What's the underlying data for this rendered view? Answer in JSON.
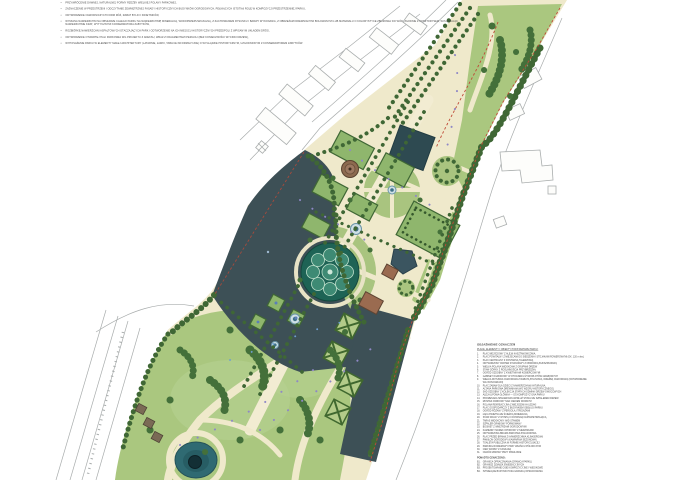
{
  "annotations": {
    "bullets": [
      "PRZYWRÓCENIE DAWNEJ, NATURALNEJ FORMY RZEŹBY WIELKIEJ POLANY PARKOWEJ,",
      "ZAZNACZENIE W PRZESTRZENI I ODCZYTANIE ZEWNĘTRZNEJ FASADY HISTORYCZNYCH BUDYNKÓW OGRODOWYCH, PEŁNIĄCYCH ISTOTNĄ ROLĘ W KOMPOZYCJI PRZESTRZENNEJ PARKU,",
      "ODTWORZENIE OGRODNICZYCH FORM RÓŻ, RABAT BYLIN I KWIETNIKÓW,",
      "WYMIANA NAWIERZCHNI NA OBSZARZE CAŁEGO PARKU NA NAWIERZCHNIĘ MINERALNĄ, WODOPRZEPUSZCZALNĄ, Z ZACHOWANIEM RYSUNKU I BARWY WYKONANIA, Z OBRZEŻAMI DREWNIANYMI BOLOWANYMI LUB MATERIAŁU O KOLORYSTYCE ZBLIŻONEJ DO WÓD, ZGODNIE Z KOSZTORYSEM, WYŁĄCZAJĄC NAWIERZCHNIE KRAT, WYTYCZNYMI KONSERWATORA ZABYTKÓW,",
      "ROZBIÓRKĘ NAWIERZCHNI ASFALTOWYCH OTACZAJĄCYCH PARK I ODTWORZENIE NA ICH MIEJSCU HISTORYCZNYCH PRZEDPOLI Z WPISANYM UKŁADEM DRÓG,",
      "ODTWORZENIE OTWARTEJ HALI PARKOWEJ WG PROJEKTU Z ANEKSU, WRAZ Z FRAGMENTAMI PERGOLI (BEZ KONIECZNOŚCI WYCINKI DRZEW),",
      "WYPOSAŻENIE PARKU W ELEMENTY MAŁEJ ARCHITEKTURY (LATARNIE, ŁAWKI, TABLICE INFORMACYJNE) O WYGLĄDZIE HISTORYCZNYM, UZGODNIONYM Z KONSERWATOREM ZABYTKÓW."
    ]
  },
  "legend": {
    "title": "OBJAŚNIENIE OZNACZEŃ",
    "subtitle": "PLACE, ELEMENTY I OBIEKTY PODSTAWOWE PARKU:",
    "items": [
      {
        "num": "1.",
        "text": "PLAC WEJŚCIOWY Z ALEJĄ KASZTANOWCOWĄ"
      },
      {
        "num": "2.",
        "text": "PLAC POWITALNY Z MIEJSCAMI DO SIEDZENIA I STOJAKAMI ROWEROWYMI (OK. 120 m kw.)"
      },
      {
        "num": "3.",
        "text": "PLAC CENTRALNY Z FONTANNĄ TALERZOWĄ"
      },
      {
        "num": "4.",
        "text": "ODTWORZONY PARTER DYWANOWY Z OBWÓDKĄ BUKSZPANOWĄ"
      },
      {
        "num": "5.",
        "text": "WIELKA POLANA WIDOKOWA Z GRUPAMI DRZEW"
      },
      {
        "num": "6.",
        "text": "STAW GÓRNY Z ROŚLINNOŚCIĄ PRZYBRZEŻNĄ"
      },
      {
        "num": "7.",
        "text": "OGRÓD OZDOBNY Z KWIETNIKAMI KOBIERCOWYMI"
      },
      {
        "num": "8.",
        "text": "GABINET OGRODOWY W OTOCZENIU ŻYWOPŁOTÓW GRABOWYCH"
      },
      {
        "num": "9.",
        "text": "WIELKA ROTUNDA OGRODOWA Z RABATĄ BYLINOWĄ I RZEŹBĄ OGRODOWĄ (ODTWORZENIE WG IKONOGRAFII)"
      },
      {
        "num": "10.",
        "text": "PLAC ZABAW DLA DZIECI Z NAWIERZCHNIĄ NATURALNĄ"
      },
      {
        "num": "11.",
        "text": "ALTANA PARKOWA DREWNIANA (WG WZORU HISTORYCZNEGO)"
      },
      {
        "num": "12.",
        "text": "SAD OZDOBNY Z KOLEKCJĄ STARYCH ODMIAN DRZEW OWOCOWYCH"
      },
      {
        "num": "13.",
        "text": "ALEJA LIPOWA GŁÓWNA — OŚ KOMPOZYCYJNA PARKU"
      },
      {
        "num": "14.",
        "text": "PROMENADA SPACEROWA WZDŁUŻ STAWU ZE SZPALEREM DRZEW"
      },
      {
        "num": "15.",
        "text": "MOSTEK PARKOWY NAD CIEKIEM WODNYM"
      },
      {
        "num": "16.",
        "text": "POLANA REKREACYJNA Z MIEJSCEM NA LEŻAKI"
      },
      {
        "num": "17.",
        "text": "PLAC GOSPODARCZY Z BUDYNKIEM OBSŁUGI PARKU"
      },
      {
        "num": "18.",
        "text": "OGRÓD RÓŻANY Z PERGOLĄ I TREJAŻAMI"
      },
      {
        "num": "19.",
        "text": "ŁĄKA KWIETNA ZE ŚCIEŻKĄ MINERALNĄ"
      },
      {
        "num": "20.",
        "text": "STAW DOLNY Z WYSPĄ I FONTANNĄ NAPOWIETRZAJĄCĄ"
      },
      {
        "num": "21.",
        "text": "TARAS WIDOKOWY NAD STAWEM"
      },
      {
        "num": "22.",
        "text": "SZPALER GRABOWY FORMOWANY"
      },
      {
        "num": "23.",
        "text": "BOSKIET Z WNĘTRZAMI OGRODOWYMI"
      },
      {
        "num": "24.",
        "text": "KAMIENNY MUREK OPOROWY Z SIEDZISKAMI"
      },
      {
        "num": "25.",
        "text": "ODTWORZONA BRAMA PARKOWA POŁUDNIOWA"
      },
      {
        "num": "26.",
        "text": "PLAC PRZED BRAMĄ Z NAWIERZCHNIĄ KLINKIEROWĄ"
      },
      {
        "num": "27.",
        "text": "PAWILON OGRODOWY (KAWIARNIA SEZONOWA)"
      },
      {
        "num": "28.",
        "text": "TOALETA PUBLICZNA W FORMIE HISTORYZUJĄCEJ"
      },
      {
        "num": "29.",
        "text": "PARKING ROWEROWY PRZY WEJŚCIU PÓŁNOCNYM"
      },
      {
        "num": "30.",
        "text": "CIEK WODNY Z KASKADĄ"
      },
      {
        "num": "31.",
        "text": "OGRÓD ZIMOWY PRZY PAWILONIE"
      }
    ],
    "extra_title": "PONADTO OZNACZONO:",
    "extra_items": [
      {
        "num": "B1.",
        "text": "GRANICA OPRACOWANIA (GRANICA PARKU)"
      },
      {
        "num": "B2.",
        "text": "GRANICE DZIAŁEK EWIDENCYJNYCH"
      },
      {
        "num": "B3.",
        "text": "PROJEKTOWANE OSIE KOMPOZYCYJNE I WIDOKOWE"
      },
      {
        "num": "B4.",
        "text": "ISTNIEJĄCE BUDYNKI POZA GRANICĄ OPRACOWANIA"
      }
    ]
  },
  "map": {
    "palette": {
      "path_cream": "#efe9cb",
      "lawn_light": "#aac77f",
      "lawn_bright": "#b6d191",
      "tree_dark": "#3f6735",
      "hedge_green": "#46713c",
      "room_green": "#8fb66d",
      "water_dark": "#3d5056",
      "pond_teal": "#2f6a72",
      "parterre_teal": "#1e6355",
      "building_brown": "#9a6b50",
      "boundary_red": "#bf4a37",
      "cadastral_gray": "#a9adad",
      "accent_purple": "#8f88c6"
    }
  }
}
